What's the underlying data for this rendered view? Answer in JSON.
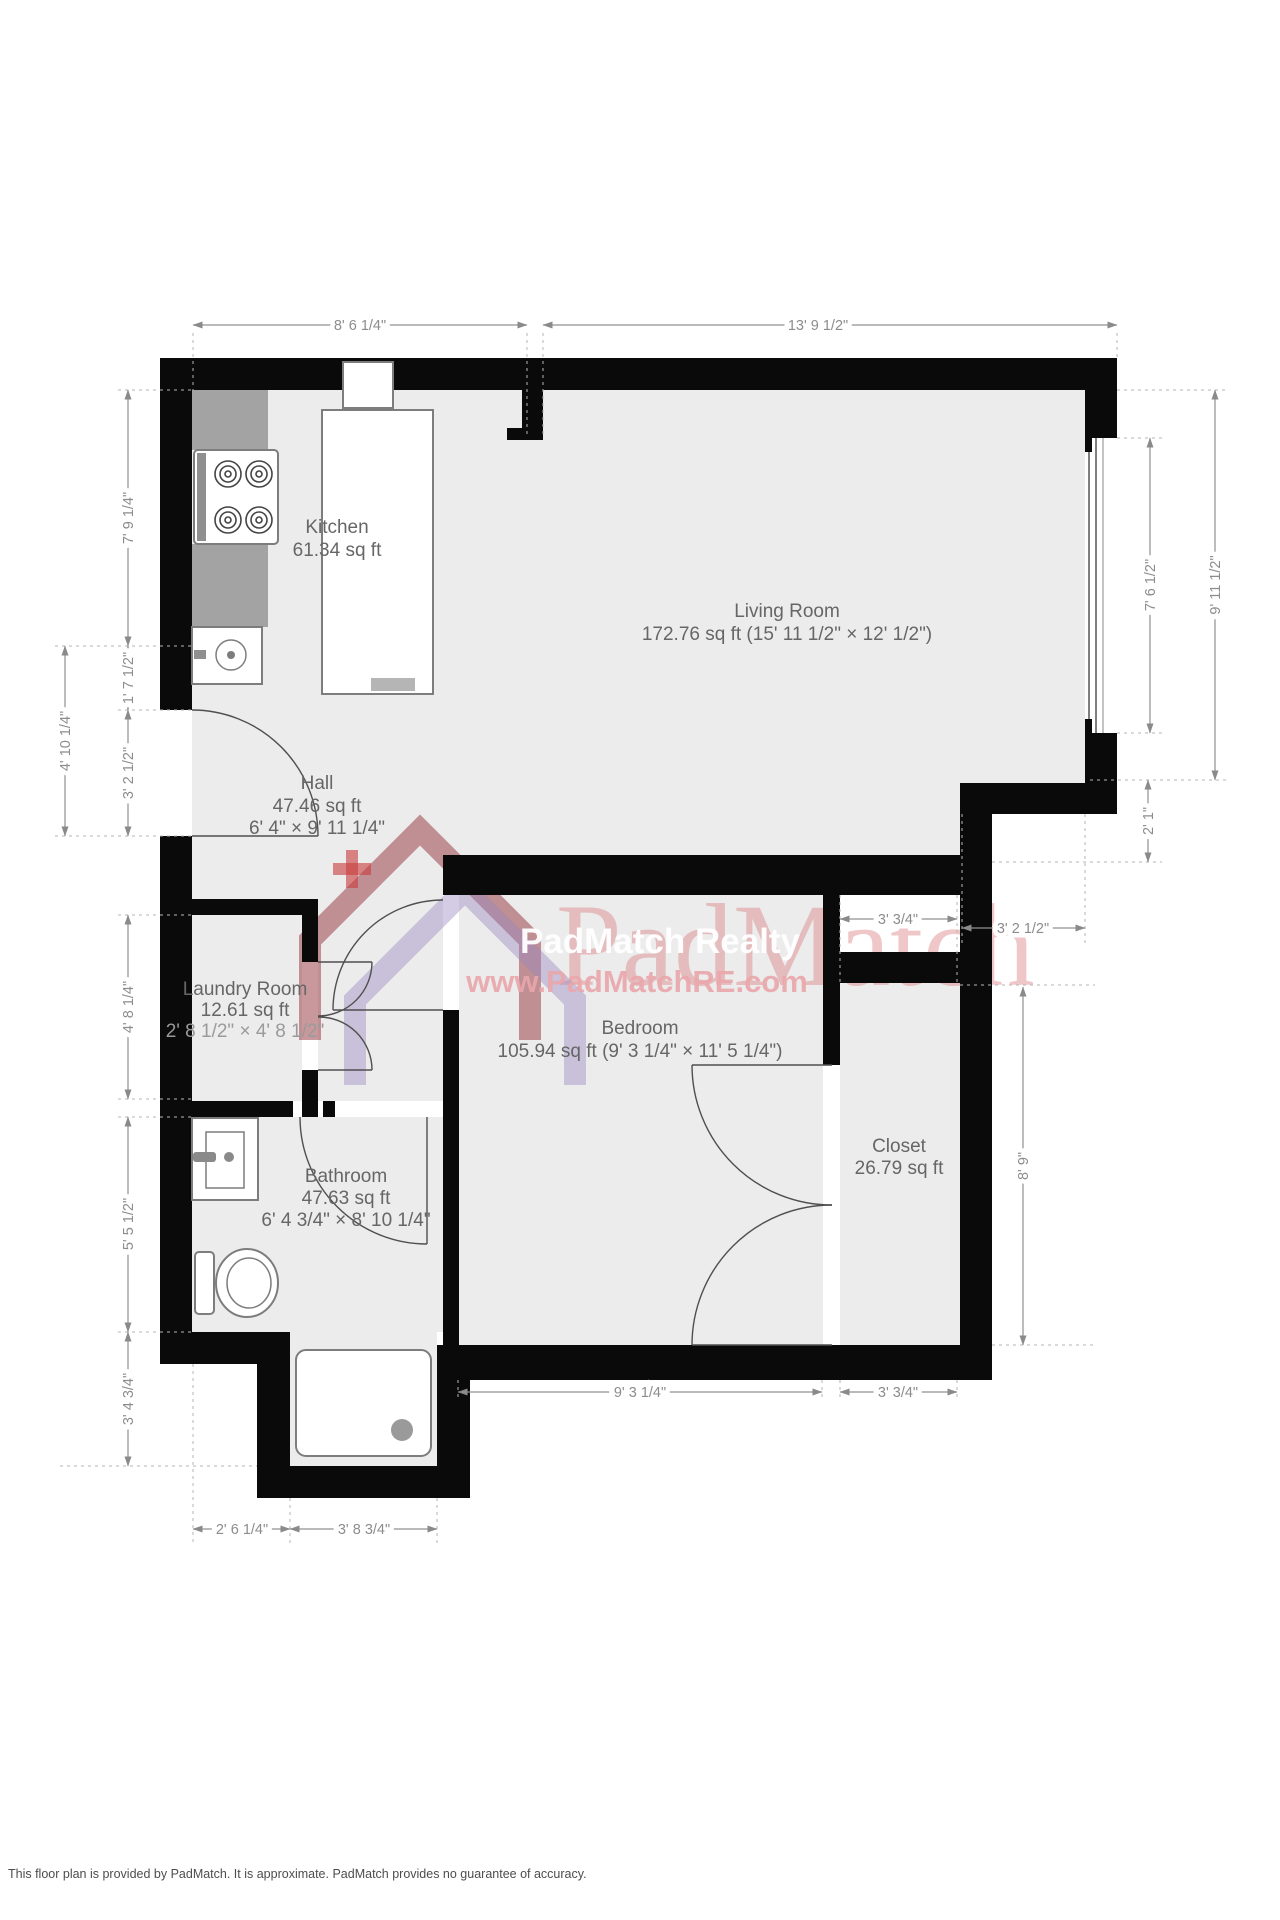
{
  "rooms": [
    {
      "name": "Kitchen",
      "area": "61.34 sq ft"
    },
    {
      "name": "Living Room",
      "area": "172.76 sq ft (15' 11 1/2\" × 12' 1/2\")"
    },
    {
      "name": "Hall",
      "area": "47.46 sq ft",
      "dims": "6' 4\" × 9' 11 1/4\""
    },
    {
      "name": "Laundry Room",
      "area": "12.61 sq ft",
      "dims": "2' 8 1/2\" × 4' 8 1/2\""
    },
    {
      "name": "Bedroom",
      "area": "105.94 sq ft (9' 3 1/4\" × 11' 5 1/4\")"
    },
    {
      "name": "Bathroom",
      "area": "47.63 sq ft",
      "dims": "6' 4 3/4\" × 8' 10 1/4\""
    },
    {
      "name": "Closet",
      "area": "26.79 sq ft"
    }
  ],
  "dimensions": {
    "top": [
      "8' 6 1/4\"",
      "13' 9 1/2\""
    ],
    "left": [
      "7' 9 1/4\"",
      "4' 10 1/4\"",
      "1' 7 1/2\"",
      "3' 2 1/2\"",
      "4' 8 1/4\"",
      "5' 5 1/2\"",
      "3' 4 3/4\""
    ],
    "right": [
      "7' 6 1/2\"",
      "9' 11 1/2\"",
      "2' 1\"",
      "3' 2 1/2\"",
      "3' 3/4\"",
      "8' 9\""
    ],
    "bottom": [
      "2' 6 1/4\"",
      "3' 8 3/4\"",
      "9' 3 1/4\"",
      "3' 3/4\""
    ]
  },
  "watermark": {
    "brand": "PadMatch",
    "realty": "PadMatch Realty",
    "url": "www.PadMatchRE.com"
  },
  "footer": {
    "text": "This floor plan is provided by PadMatch. It is approximate. PadMatch provides no guarantee of accuracy."
  },
  "colors": {
    "wall": "#0a0a0a",
    "floor": "#ececec",
    "watermark_pink": "#db8286",
    "watermark_purple": "#9686be",
    "watermark_maroon": "#94313b"
  }
}
